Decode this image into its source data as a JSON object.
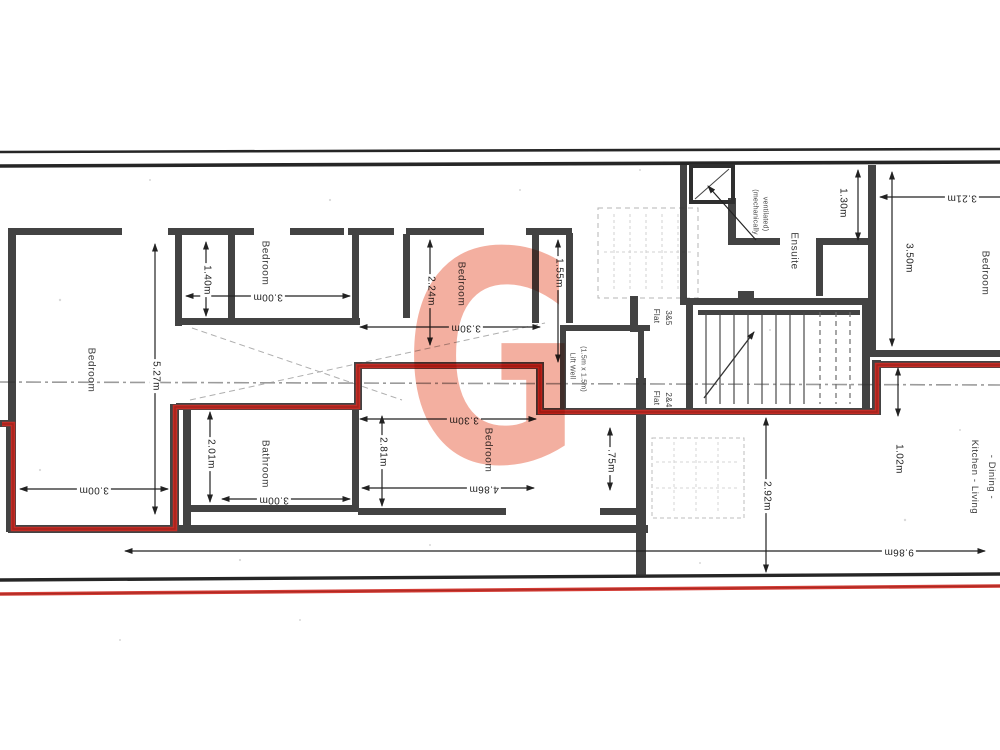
{
  "watermark": {
    "letter": "G",
    "color": "#e96d52"
  },
  "rooms": {
    "bedroom_left": "Bedroom",
    "bedroom_top_mid": "Bedroom",
    "bedroom_mid": "Bedroom",
    "bedroom_bottom_mid": "Bedroom",
    "bathroom": "Bathroom",
    "bedroom_right": "Bedroom",
    "ensuite": "Ensuite",
    "lift_line1": "Lift Well",
    "lift_line2": "(1.5m x 1.5m)",
    "kitchen_line1": "Kitchen - Living",
    "kitchen_line2": "- Dining -"
  },
  "flats": {
    "upper_word": "Flat",
    "upper_num": "3&5",
    "lower_word": "Flat",
    "lower_num": "2&4"
  },
  "notes": {
    "mech_line1": "(mechanically",
    "mech_line2": "ventilated)"
  },
  "dims": {
    "w140": "1.40m",
    "h527": "5.27m",
    "w300_top": "3.00m",
    "h201": "2.01m",
    "w300_bath": "3.00m",
    "w300_left": "3.00m",
    "h224": "2.24m",
    "w330_top": "3.30m",
    "h281": "2.81m",
    "w330_bot": "3.30m",
    "w486": "4.86m",
    "h155": "1.55m",
    "h75": ".75m",
    "h292": "2.92m",
    "h102": "1.02m",
    "w986": "9.86m",
    "h130": "1.30m",
    "w321": "3.21m",
    "h350": "3.50m"
  },
  "boundary_color": "#cf2b24"
}
